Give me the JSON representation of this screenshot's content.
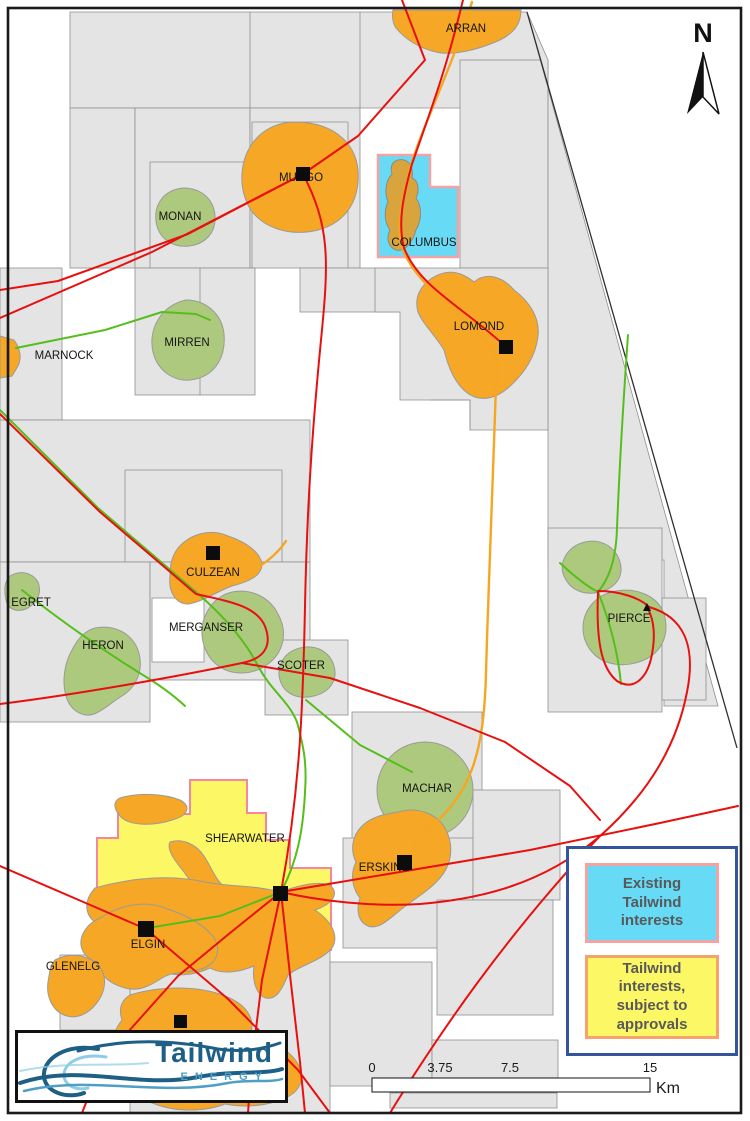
{
  "fields": {
    "arran": "ARRAN",
    "mungo": "MUNGO",
    "monan": "MONAN",
    "columbus": "COLUMBUS",
    "lomond": "LOMOND",
    "marnock": "MARNOCK",
    "mirren": "MIRREN",
    "culzean": "CULZEAN",
    "egret": "EGRET",
    "heron": "HERON",
    "merganser": "MERGANSER",
    "scoter": "SCOTER",
    "pierce": "PIERCE",
    "machar": "MACHAR",
    "shearwater": "SHEARWATER",
    "erskine": "ERSKINE",
    "elgin": "ELGIN",
    "glenelg": "GLENELG"
  },
  "legend": {
    "items": [
      {
        "label": "Existing Tailwind interests",
        "fill": "#67DAF6",
        "border": "#F2A4A4"
      },
      {
        "label": "Tailwind interests, subject to approvals",
        "fill": "#FBF765",
        "border": "#F5A36B"
      }
    ]
  },
  "scalebar": {
    "ticks": [
      "0",
      "3.75",
      "7.5",
      "15"
    ],
    "unit": "Km"
  },
  "north_arrow": {
    "label": "N"
  },
  "logo": {
    "title": "Tailwind",
    "subtitle": "ENERGY"
  },
  "colors": {
    "block_gray": "#E4E4E4",
    "block_border": "#8F8F8F",
    "field_orange": "#F6A725",
    "field_green": "#ADC97D",
    "columbus_orange": "#D9A43C",
    "tailwind_blue": "#67DAF6",
    "tailwind_yellow": "#FBF765",
    "pink_border": "#F2A4A4",
    "yellow_border": "#F5A36B",
    "shearwater_border": "#F4879B",
    "pipeline_red": "#E8100F",
    "pipeline_green": "#56BE1C",
    "pipeline_orange": "#F5A623",
    "legend_border": "#34549C",
    "legend_text": "#595959",
    "logo_dark_blue": "#1E5F86",
    "logo_mid_blue": "#4E9EC6",
    "logo_light_blue": "#8FCDE6",
    "label_color": "#141414"
  }
}
